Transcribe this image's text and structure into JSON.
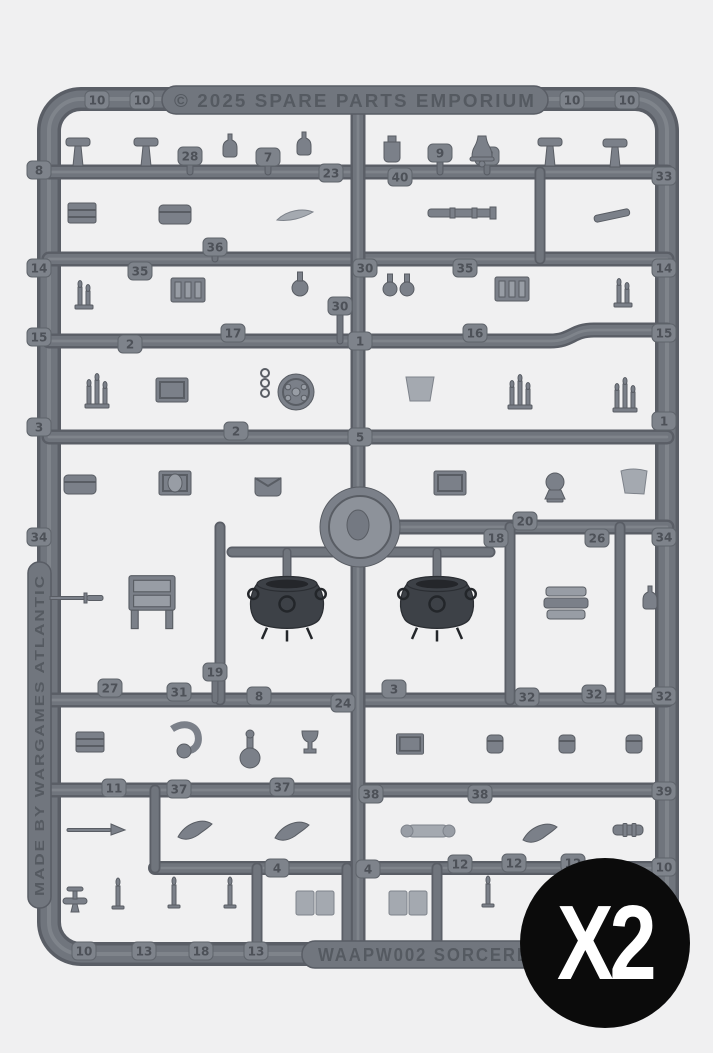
{
  "photo": {
    "background": "#f0f0f1",
    "plastic": "#70757d",
    "plastic_dark": "#5a5e66",
    "plastic_light": "#878c94",
    "part_fill": "#7b8089",
    "cauldron_color": "#3d4147"
  },
  "sprue": {
    "top_text": "© 2025 SPARE PARTS EMPORIUM",
    "bottom_text": "WAAPW002 SORCERE",
    "side_text": "MADE BY WARGAMES ATLANTIC",
    "tabs": [
      {
        "n": "10",
        "x": 97,
        "y": 100
      },
      {
        "n": "10",
        "x": 142,
        "y": 100
      },
      {
        "n": "10",
        "x": 572,
        "y": 100
      },
      {
        "n": "10",
        "x": 627,
        "y": 100
      },
      {
        "n": "8",
        "x": 39,
        "y": 170
      },
      {
        "n": "28",
        "x": 190,
        "y": 156
      },
      {
        "n": "7",
        "x": 268,
        "y": 157
      },
      {
        "n": "23",
        "x": 331,
        "y": 173
      },
      {
        "n": "40",
        "x": 400,
        "y": 177
      },
      {
        "n": "9",
        "x": 440,
        "y": 153
      },
      {
        "n": "21",
        "x": 487,
        "y": 156
      },
      {
        "n": "33",
        "x": 664,
        "y": 176
      },
      {
        "n": "14",
        "x": 39,
        "y": 268
      },
      {
        "n": "35",
        "x": 140,
        "y": 271
      },
      {
        "n": "36",
        "x": 215,
        "y": 247
      },
      {
        "n": "30",
        "x": 365,
        "y": 268
      },
      {
        "n": "35",
        "x": 465,
        "y": 268
      },
      {
        "n": "14",
        "x": 664,
        "y": 268
      },
      {
        "n": "15",
        "x": 39,
        "y": 337
      },
      {
        "n": "2",
        "x": 130,
        "y": 344
      },
      {
        "n": "17",
        "x": 233,
        "y": 333
      },
      {
        "n": "30",
        "x": 340,
        "y": 306
      },
      {
        "n": "1",
        "x": 360,
        "y": 341
      },
      {
        "n": "16",
        "x": 475,
        "y": 333
      },
      {
        "n": "15",
        "x": 664,
        "y": 333
      },
      {
        "n": "3",
        "x": 39,
        "y": 427
      },
      {
        "n": "2",
        "x": 236,
        "y": 431
      },
      {
        "n": "5",
        "x": 360,
        "y": 437
      },
      {
        "n": "1",
        "x": 664,
        "y": 421
      },
      {
        "n": "34",
        "x": 39,
        "y": 537
      },
      {
        "n": "18",
        "x": 496,
        "y": 538
      },
      {
        "n": "20",
        "x": 525,
        "y": 521
      },
      {
        "n": "26",
        "x": 597,
        "y": 538
      },
      {
        "n": "34",
        "x": 664,
        "y": 537
      },
      {
        "n": "27",
        "x": 110,
        "y": 688
      },
      {
        "n": "31",
        "x": 179,
        "y": 692
      },
      {
        "n": "19",
        "x": 215,
        "y": 672
      },
      {
        "n": "8",
        "x": 259,
        "y": 696
      },
      {
        "n": "24",
        "x": 343,
        "y": 703
      },
      {
        "n": "3",
        "x": 394,
        "y": 689
      },
      {
        "n": "32",
        "x": 527,
        "y": 697
      },
      {
        "n": "32",
        "x": 594,
        "y": 694
      },
      {
        "n": "32",
        "x": 664,
        "y": 696
      },
      {
        "n": "11",
        "x": 114,
        "y": 788
      },
      {
        "n": "37",
        "x": 179,
        "y": 789
      },
      {
        "n": "37",
        "x": 282,
        "y": 787
      },
      {
        "n": "38",
        "x": 371,
        "y": 794
      },
      {
        "n": "38",
        "x": 480,
        "y": 794
      },
      {
        "n": "39",
        "x": 664,
        "y": 791
      },
      {
        "n": "4",
        "x": 277,
        "y": 868
      },
      {
        "n": "4",
        "x": 368,
        "y": 869
      },
      {
        "n": "12",
        "x": 460,
        "y": 864
      },
      {
        "n": "12",
        "x": 514,
        "y": 863
      },
      {
        "n": "12",
        "x": 573,
        "y": 863
      },
      {
        "n": "10",
        "x": 664,
        "y": 867
      },
      {
        "n": "10",
        "x": 84,
        "y": 951
      },
      {
        "n": "13",
        "x": 144,
        "y": 951
      },
      {
        "n": "18",
        "x": 201,
        "y": 951
      },
      {
        "n": "13",
        "x": 256,
        "y": 951
      }
    ],
    "parts": [
      {
        "t": "mallet",
        "x": 78,
        "y": 150
      },
      {
        "t": "mallet",
        "x": 146,
        "y": 150
      },
      {
        "t": "bottle",
        "x": 230,
        "y": 147
      },
      {
        "t": "bottle",
        "x": 304,
        "y": 145
      },
      {
        "t": "jug",
        "x": 392,
        "y": 148
      },
      {
        "t": "bell",
        "x": 482,
        "y": 148
      },
      {
        "t": "mallet",
        "x": 550,
        "y": 150
      },
      {
        "t": "mallet",
        "x": 615,
        "y": 151
      },
      {
        "t": "crate",
        "x": 82,
        "y": 213
      },
      {
        "t": "satchel",
        "x": 175,
        "y": 214
      },
      {
        "t": "quill",
        "x": 295,
        "y": 216
      },
      {
        "t": "telescope",
        "x": 462,
        "y": 213
      },
      {
        "t": "strap",
        "x": 612,
        "y": 216
      },
      {
        "t": "candelabra2",
        "x": 84,
        "y": 295
      },
      {
        "t": "shelf",
        "x": 188,
        "y": 290
      },
      {
        "t": "flask",
        "x": 300,
        "y": 284
      },
      {
        "t": "bottlepair",
        "x": 398,
        "y": 284
      },
      {
        "t": "shelf",
        "x": 512,
        "y": 289
      },
      {
        "t": "candelabra2",
        "x": 623,
        "y": 293
      },
      {
        "t": "candelabra3",
        "x": 97,
        "y": 392
      },
      {
        "t": "tome",
        "x": 172,
        "y": 390
      },
      {
        "t": "chain",
        "x": 265,
        "y": 383
      },
      {
        "t": "shield",
        "x": 296,
        "y": 392
      },
      {
        "t": "banner",
        "x": 420,
        "y": 389
      },
      {
        "t": "candelabra3",
        "x": 520,
        "y": 393
      },
      {
        "t": "candelabra3",
        "x": 625,
        "y": 396
      },
      {
        "t": "satchel",
        "x": 80,
        "y": 484
      },
      {
        "t": "tomeoval",
        "x": 175,
        "y": 483
      },
      {
        "t": "bag",
        "x": 268,
        "y": 486
      },
      {
        "t": "tome",
        "x": 450,
        "y": 483
      },
      {
        "t": "orb",
        "x": 555,
        "y": 487
      },
      {
        "t": "drape",
        "x": 634,
        "y": 482
      },
      {
        "t": "medallion",
        "x": 360,
        "y": 527
      },
      {
        "t": "sword",
        "x": 80,
        "y": 598
      },
      {
        "t": "desk",
        "x": 152,
        "y": 601,
        "s": 1.15
      },
      {
        "t": "cauldron",
        "x": 287,
        "y": 604,
        "s": 1.25
      },
      {
        "t": "cauldron",
        "x": 437,
        "y": 604,
        "s": 1.25
      },
      {
        "t": "scrolls",
        "x": 566,
        "y": 601
      },
      {
        "t": "bottle",
        "x": 650,
        "y": 599
      },
      {
        "t": "crate",
        "x": 90,
        "y": 742
      },
      {
        "t": "pipe",
        "x": 190,
        "y": 737
      },
      {
        "t": "funnel",
        "x": 250,
        "y": 750
      },
      {
        "t": "goblet",
        "x": 310,
        "y": 745
      },
      {
        "t": "tome",
        "x": 410,
        "y": 744,
        "s": 0.85
      },
      {
        "t": "pouch",
        "x": 495,
        "y": 744
      },
      {
        "t": "pouch",
        "x": 567,
        "y": 744
      },
      {
        "t": "pouch",
        "x": 634,
        "y": 744
      },
      {
        "t": "spear",
        "x": 95,
        "y": 830
      },
      {
        "t": "horn",
        "x": 195,
        "y": 830
      },
      {
        "t": "horn",
        "x": 292,
        "y": 831
      },
      {
        "t": "scrollpart",
        "x": 428,
        "y": 831
      },
      {
        "t": "horn",
        "x": 540,
        "y": 833
      },
      {
        "t": "tube",
        "x": 628,
        "y": 830
      },
      {
        "t": "spigot",
        "x": 75,
        "y": 901
      },
      {
        "t": "candle",
        "x": 118,
        "y": 896
      },
      {
        "t": "candle",
        "x": 174,
        "y": 895
      },
      {
        "t": "candle",
        "x": 230,
        "y": 895
      },
      {
        "t": "openbook",
        "x": 315,
        "y": 903
      },
      {
        "t": "openbook",
        "x": 408,
        "y": 903
      },
      {
        "t": "candle",
        "x": 488,
        "y": 894
      }
    ]
  },
  "badge": {
    "label": "X2",
    "background": "#0b0b0b",
    "color": "#ffffff"
  }
}
